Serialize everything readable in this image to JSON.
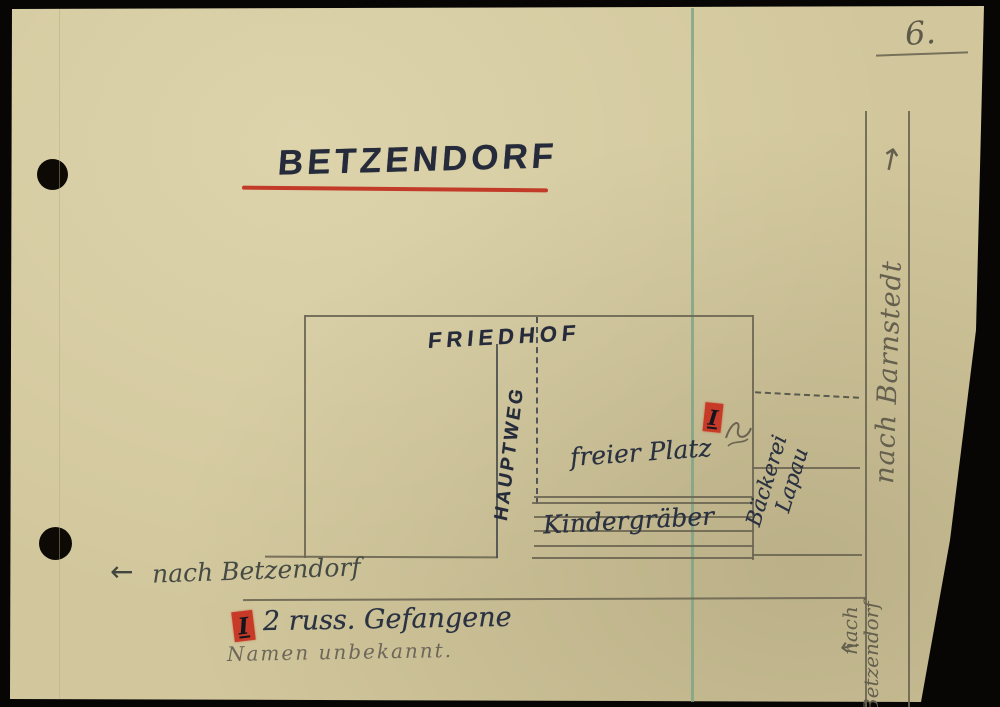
{
  "page": {
    "number": "6."
  },
  "title": {
    "text": "BETZENDORF"
  },
  "map": {
    "friedhof_label": "FRIEDHOF",
    "hauptweg_label": "HAUPTWEG",
    "freier_platz_label": "freier Platz",
    "kindergraeber_label": "Kindergräber",
    "baeckerei_label_line1": "Bäckerei",
    "baeckerei_label_line2": "Lapau",
    "marker_numeral": "I"
  },
  "roads": {
    "right_top_label": "nach Barnstedt",
    "right_top_arrow": "↑",
    "right_bottom_label_line1": "nach",
    "right_bottom_label_line2": "Betzendorf",
    "right_bottom_arrow": "←",
    "bottom_label": "nach Betzendorf",
    "bottom_arrow": "←"
  },
  "legend": {
    "marker_numeral": "I",
    "entry": "2 russ. Gefangene",
    "note": "Namen unbekannt."
  },
  "colors": {
    "paper": "#d2c79c",
    "ink": "#273042",
    "pencil": "#6b6453",
    "red": "#c63a27",
    "teal_line": "#7ba486",
    "background": "#070605"
  }
}
